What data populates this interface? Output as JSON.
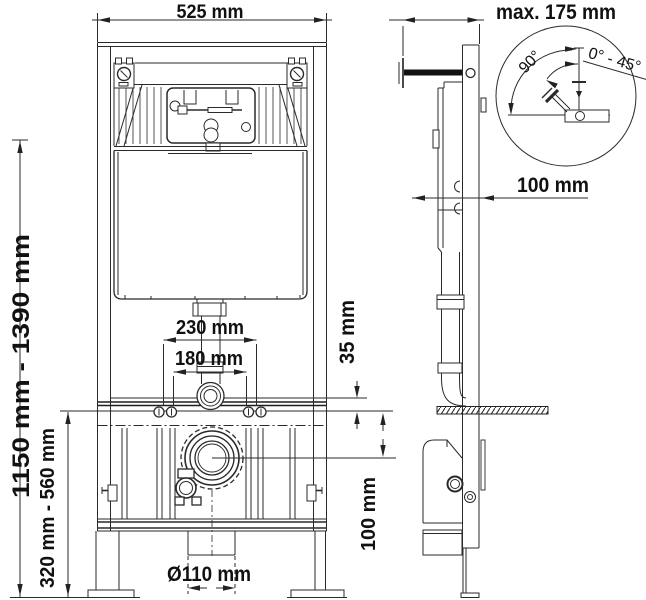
{
  "front_view": {
    "width_label": "525 mm",
    "height_range_label": "1150 mm - 1390 mm",
    "leg_range_label": "320 mm - 560 mm",
    "bolt_spacing_outer_label": "230 mm",
    "bolt_spacing_inner_label": "180 mm",
    "drain_diameter_label": "Ø110 mm"
  },
  "side_view": {
    "depth_label": "max. 175 mm",
    "wall_distance_label": "100 mm",
    "rail_gap_label": "35 mm",
    "drain_height_label": "100 mm"
  },
  "detail_view": {
    "swing_angle_label": "90°",
    "angle_range_label": "0° - 45°"
  },
  "colors": {
    "line": "#222222",
    "background": "#ffffff",
    "text": "#111111"
  }
}
